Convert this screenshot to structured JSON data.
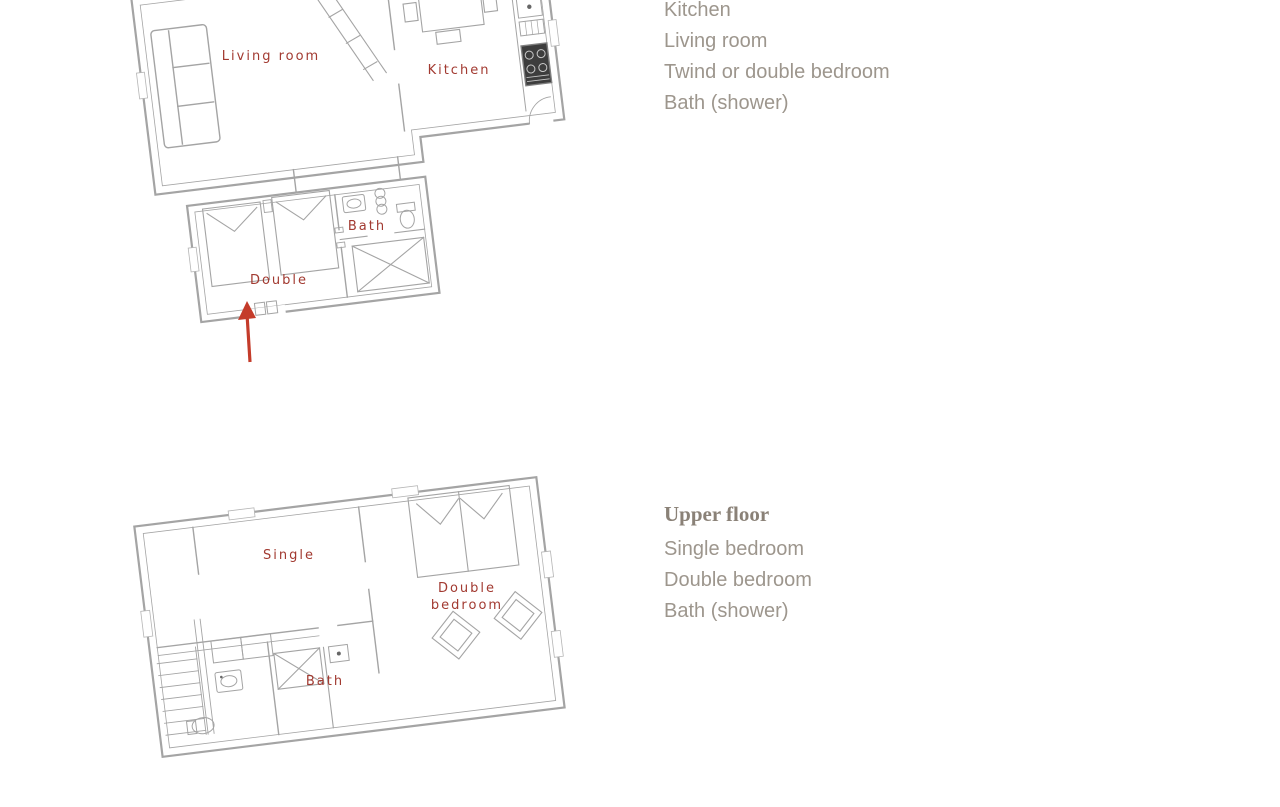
{
  "page": {
    "background": "#ffffff"
  },
  "colors": {
    "plan_wall": "#a4a4a4",
    "plan_furniture": "#9e9e9e",
    "room_label": "#a23a31",
    "entrance_arrow": "#c43b2a",
    "legend_text": "#9d968d",
    "heading_text": "#8a8177"
  },
  "ground_floor": {
    "plan_labels": {
      "living_room": "Living room",
      "kitchen": "Kitchen",
      "bath": "Bath",
      "double": "Double"
    },
    "legend": {
      "items": [
        "Kitchen",
        "Living room",
        "Twind or double bedroom",
        "Bath (shower)"
      ]
    }
  },
  "upper_floor": {
    "plan_labels": {
      "single": "Single",
      "double_bedroom_line1": "Double",
      "double_bedroom_line2": "bedroom",
      "bath": "Bath"
    },
    "legend": {
      "title": "Upper floor",
      "items": [
        "Single bedroom",
        "Double bedroom",
        "Bath (shower)"
      ]
    }
  }
}
